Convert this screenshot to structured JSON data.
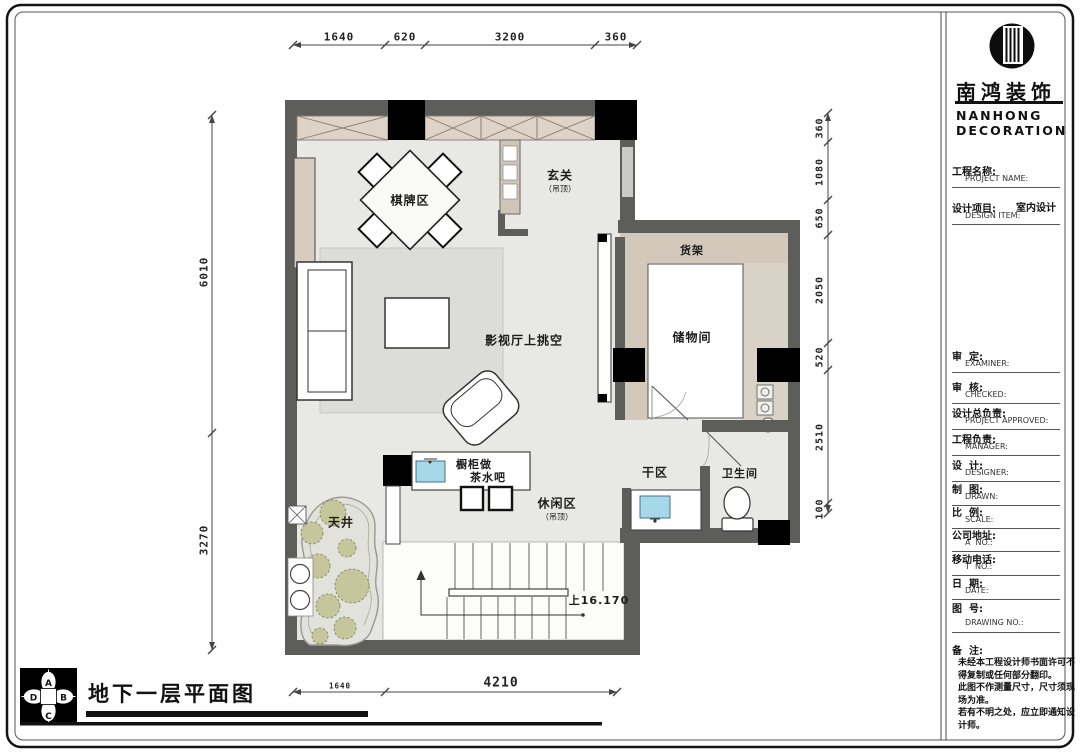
{
  "drawing": {
    "plan_title": "地下一层平面图",
    "stairs_note": "上16.170",
    "rooms": {
      "qipai": "棋牌区",
      "xuanguan": "玄关",
      "xuanguan_sub": "（吊顶）",
      "huojia": "货架",
      "chuwujian": "储物间",
      "yingshiting": "影视厅上挑空",
      "ganqu": "干区",
      "weishengjian": "卫生间",
      "xiuxianqu": "休闲区",
      "xiuxianqu_sub": "（吊顶）",
      "chugui_line1": "橱柜做",
      "chugui_line2": "茶水吧",
      "tianjing": "天井"
    },
    "dimensions": {
      "top": [
        "1640",
        "620",
        "3200",
        "360"
      ],
      "bottom": [
        "1640",
        "4210"
      ],
      "left": [
        "6010",
        "3270"
      ],
      "right": [
        "360",
        "1080",
        "650",
        "2050",
        "520",
        "2510",
        "100"
      ]
    },
    "compass": {
      "n": "A",
      "e": "B",
      "s": "C",
      "w": "D"
    }
  },
  "titleblock": {
    "logo_cn": "南鸿装饰",
    "logo_en_line1": "NANHONG",
    "logo_en_line2": "DECORATION",
    "fields": [
      {
        "cn": "工程名称:",
        "en": "PROJECT NAME:",
        "value": ""
      },
      {
        "cn": "设计项目:",
        "en": "DESIGN ITEM:",
        "value": "室内设计"
      },
      {
        "cn": "审  定:",
        "en": "EXAMINER:",
        "value": ""
      },
      {
        "cn": "审  核:",
        "en": "CHECKED:",
        "value": ""
      },
      {
        "cn": "设计总负责:",
        "en": "PROJECT APPROVED:",
        "value": ""
      },
      {
        "cn": "工程负责:",
        "en": "MANAGER:",
        "value": ""
      },
      {
        "cn": "设  计:",
        "en": "DESIGNER:",
        "value": ""
      },
      {
        "cn": "制  图:",
        "en": "DRAWN:",
        "value": ""
      },
      {
        "cn": "比  例:",
        "en": "SCALE:",
        "value": ""
      },
      {
        "cn": "公司地址:",
        "en": "A  NO.:",
        "value": ""
      },
      {
        "cn": "移动电话:",
        "en": "T  NO.:",
        "value": ""
      },
      {
        "cn": "日  期:",
        "en": "DATE:",
        "value": ""
      },
      {
        "cn": "图  号:",
        "en": "DRAWING NO.:",
        "value": ""
      }
    ],
    "remark_label": "备  注:",
    "remark_lines": [
      "未经本工程设计师书面许可不",
      "得复制或任何部分翻印。",
      "此图不作测量尺寸，尺寸须现",
      "场为准。",
      "若有不明之处，应立即通知设",
      "计师。"
    ]
  },
  "colors": {
    "wall": "#5d5d59",
    "floor": "#e8e8e5",
    "tan": "#d2c9bb",
    "sink": "#a5d9e9"
  }
}
